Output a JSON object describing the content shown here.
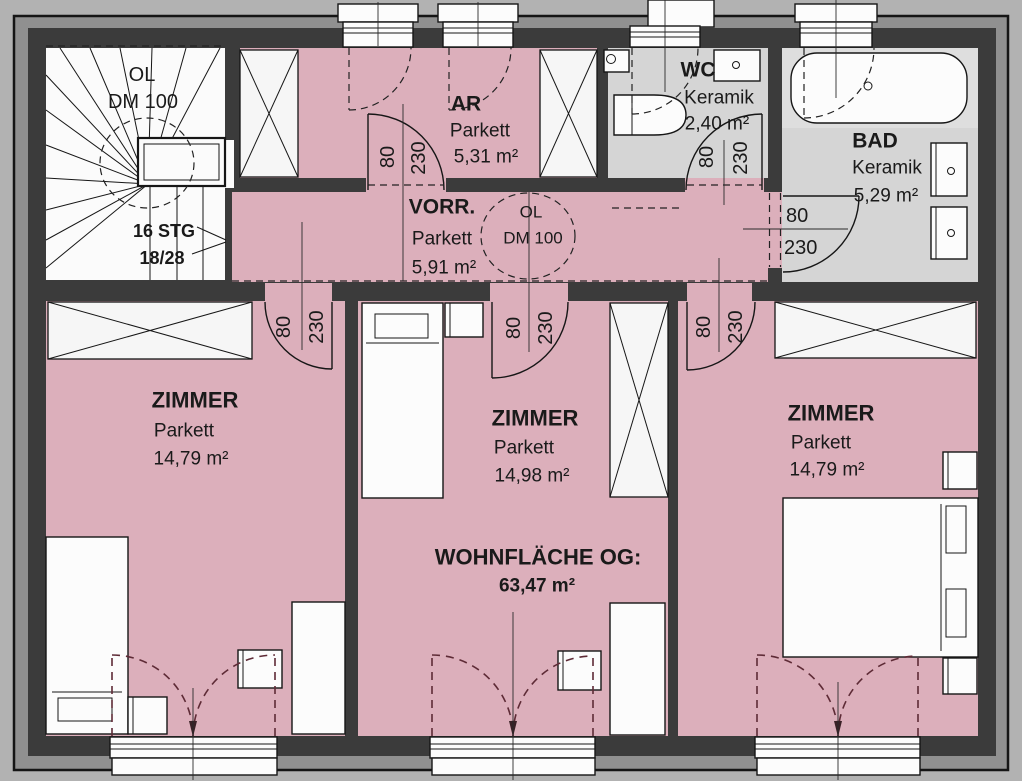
{
  "floorplan": {
    "stairwell": {
      "skylight": "OL",
      "skylight_dim": "DM 100",
      "steps": "16 STG",
      "step_dim": "18/28"
    },
    "hall_skylight": {
      "label": "OL",
      "dim": "DM 100"
    },
    "rooms": {
      "ar": {
        "name": "AR",
        "floor": "Parkett",
        "area": "5,31 m²"
      },
      "vorr": {
        "name": "VORR.",
        "floor": "Parkett",
        "area": "5,91 m²"
      },
      "wc": {
        "name": "WC",
        "floor": "Keramik",
        "area": "2,40 m²"
      },
      "bad": {
        "name": "BAD",
        "floor": "Keramik",
        "area": "5,29 m²"
      },
      "zimmer_left": {
        "name": "ZIMMER",
        "floor": "Parkett",
        "area": "14,79 m²"
      },
      "zimmer_middle": {
        "name": "ZIMMER",
        "floor": "Parkett",
        "area": "14,98 m²"
      },
      "zimmer_right": {
        "name": "ZIMMER",
        "floor": "Parkett",
        "area": "14,79 m²"
      }
    },
    "summary": {
      "label": "WOHNFLÄCHE OG:",
      "value": "63,47 m²"
    },
    "door": {
      "width": "80",
      "height": "230"
    },
    "colors": {
      "room_fill": "#dcafbb",
      "tile_fill": "#d5d5d5",
      "wall": "#3b3b3b",
      "eaves": "#909090",
      "swing_dash": "#5e2b36"
    }
  }
}
